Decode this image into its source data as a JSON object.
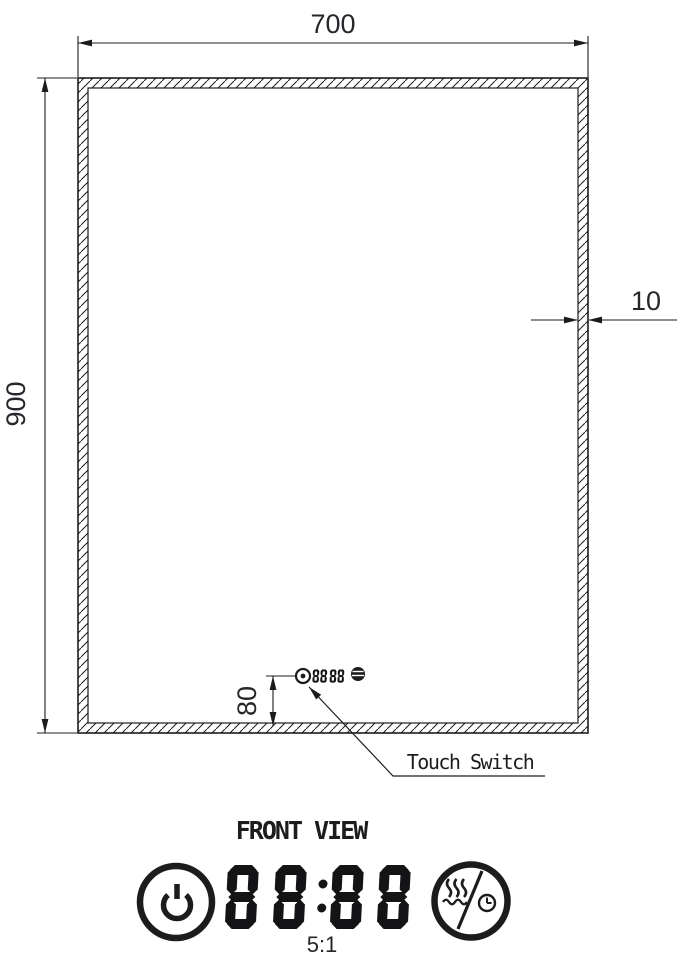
{
  "meta": {
    "view_title": "FRONT VIEW",
    "detail_scale": "5:1"
  },
  "dimensions": {
    "width_mm": "700",
    "height_mm": "900",
    "frame_thickness_mm": "10",
    "switch_offset_mm": "80"
  },
  "callouts": {
    "touch_switch": "Touch Switch"
  },
  "touch_panel": {
    "display_value": "88:88",
    "icons": [
      "power-icon",
      "defogger-timer-icon"
    ]
  },
  "colors": {
    "ink": "#1c1c1f",
    "background": "#ffffff"
  }
}
